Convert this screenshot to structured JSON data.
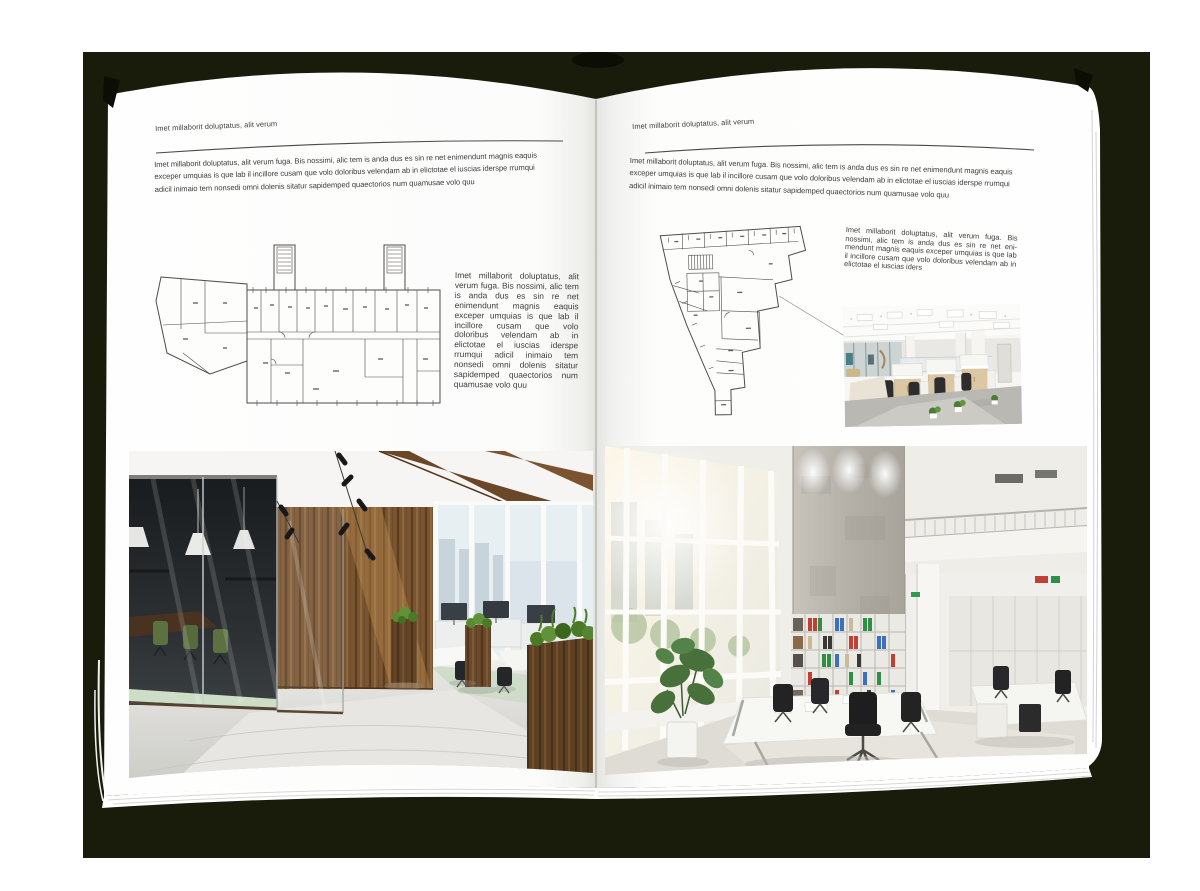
{
  "colors": {
    "backdrop": "#1a1c0b",
    "paper": "#ffffff",
    "text": "#3e3d3b",
    "rule": "#4b4b48"
  },
  "left_page": {
    "header": "Imet millaborit doluptatus, alit verum",
    "intro": "Imet millaborit doluptatus, alit verum fuga. Bis nossimi, alic tem is anda dus es sin re net enimendunt magnis eaquis exceper umquias is que lab il incillore cusam que volo doloribus velendam ab in elictotae el iuscias iderspe rrumqui adicil inimaio tem nonsedi omni dolenis sitatur sapidemped quaectorios num quamusae volo quu",
    "side_text": "Imet millaborit doluptatus, alit verum fuga. Bis nossimi, alic tem is anda dus es sin re net enimendunt magnis eaquis exceper umquias is que lab il incillore cusam que volo doloribus velendam ab in elictotae el iuscias iderspe rrumqui adicil inimaio tem nonsedi omni dolenis sitatur sapidemped quaectorios num quamusae volo quu"
  },
  "right_page": {
    "header": "Imet millaborit doluptatus, alit verum",
    "intro": "Imet millaborit doluptatus, alit verum fuga. Bis nossimi, alic tem is anda dus es sin re net enimendunt magnis eaquis exceper umquias is que lab il incillore cusam que volo doloribus velendam ab in elictotae el iuscias iderspe rrumqui adicil inimaio tem nonsedi omni dolenis sitatur sapidemped quaectorios num quamusae volo quu",
    "side_text": "Imet millaborit doluptatus, alit verum fuga. Bis nossimi, alic tem is anda dus es sin re net eni-mendunt magnis eaquis exceper umquias is que lab il incillore cusam que volo doloribus velendam ab in elictotae el iuscias iders"
  }
}
